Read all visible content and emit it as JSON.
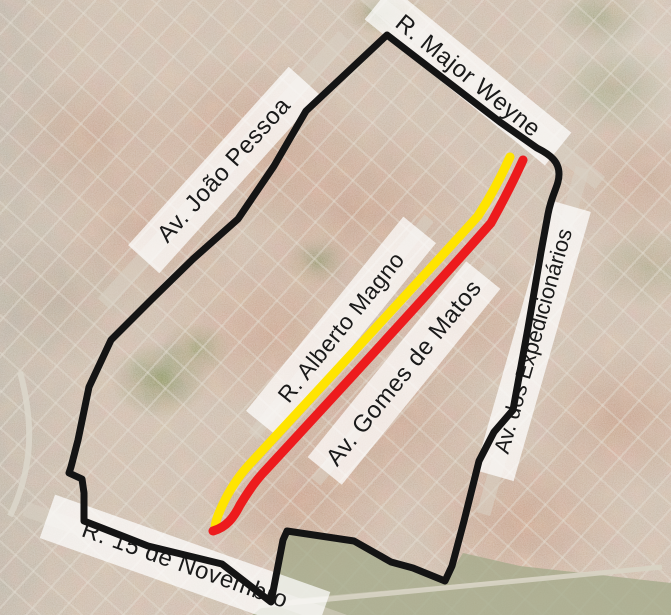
{
  "map": {
    "street_labels": [
      {
        "id": "major-weyne",
        "text": "R. Major Weyne"
      },
      {
        "id": "joao-pessoa",
        "text": "Av. João Pessoa"
      },
      {
        "id": "alberto-magno",
        "text": "R. Alberto Magno"
      },
      {
        "id": "gomes-de-matos",
        "text": "Av. Gomes de Matos"
      },
      {
        "id": "expedicionarios",
        "text": "Av. dos Expedicionários"
      },
      {
        "id": "15-de-novembro",
        "text": "R. 15 de Novembro"
      }
    ],
    "boundary": {
      "color": "#141414",
      "stroke_width": "7",
      "d": "M 387 35 L 435 72 L 500 122 L 537 148 C 551 155 559 162 559 174 C 559 186 552 193 548 214 L 541 252 L 528 328 L 513 410 L 494 432 L 479 461 L 464 521 L 452 566 L 445 581 L 413 568 L 391 562 L 354 541 L 287 531 L 283 540 L 271 602 L 222 564 L 148 546 L 84 521 L 84 493 L 82 479 L 69 473 L 71 467 L 78 440 L 89 387 L 111 340 L 151 300 L 193 259 L 238 219 L 274 166 L 306 111 Z"
    },
    "routes": [
      {
        "name": "route-yellow-alberto-magno",
        "color": "#FFE400",
        "stroke_width": "9",
        "d": "M 510 157 C 501 177 489 199 478 216 C 401 301 321 387 248 466 C 238 477 229 491 222 506 C 218 515 215 522 215 529"
      },
      {
        "name": "route-red-gomes-de-matos",
        "color": "#ED1B1D",
        "stroke_width": "9",
        "d": "M 523 160 C 513 182 501 205 491 223 C 415 309 335 395 263 473 C 253 484 246 495 240 505 C 234 517 227 527 213 531"
      }
    ],
    "terrain": {
      "airfield_points": "252,615 268,603 286,534 354,542 413,569 445,582 463,553 520,566 671,583 671,615",
      "airfield_color": "#a3a989",
      "runway_d": "M 258 606 L 662 567",
      "runway2_d": "M 292 600 L 560 576",
      "left_road_d": "M 20 372 C 34 424 33 468 10 516"
    }
  }
}
